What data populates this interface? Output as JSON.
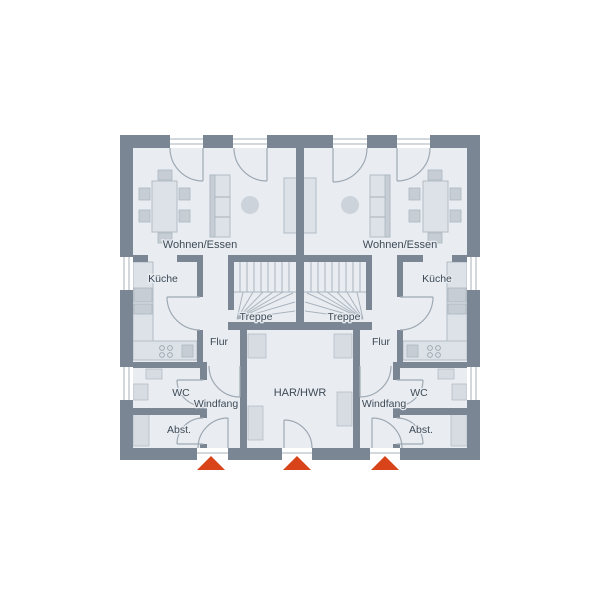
{
  "floor_plan": {
    "units": [
      {
        "side": "left",
        "rooms": [
          {
            "name": "Wohnen/Essen"
          },
          {
            "name": "Küche"
          },
          {
            "name": "Treppe"
          },
          {
            "name": "Flur"
          },
          {
            "name": "WC"
          },
          {
            "name": "Windfang"
          },
          {
            "name": "Abst."
          }
        ]
      },
      {
        "side": "right",
        "rooms": [
          {
            "name": "Wohnen/Essen"
          },
          {
            "name": "Küche"
          },
          {
            "name": "Treppe"
          },
          {
            "name": "Flur"
          },
          {
            "name": "WC"
          },
          {
            "name": "Windfang"
          },
          {
            "name": "Abst."
          }
        ]
      }
    ],
    "shared_rooms": [
      {
        "name": "HAR/HWR"
      }
    ],
    "entrances": {
      "count": 3,
      "marker_color": "#d8431a"
    },
    "colors": {
      "walls": "#7b8694",
      "floor": "#e9edf2",
      "furniture": "#dde2e8",
      "accent": "#d8431a",
      "text": "#3e4a56"
    }
  }
}
